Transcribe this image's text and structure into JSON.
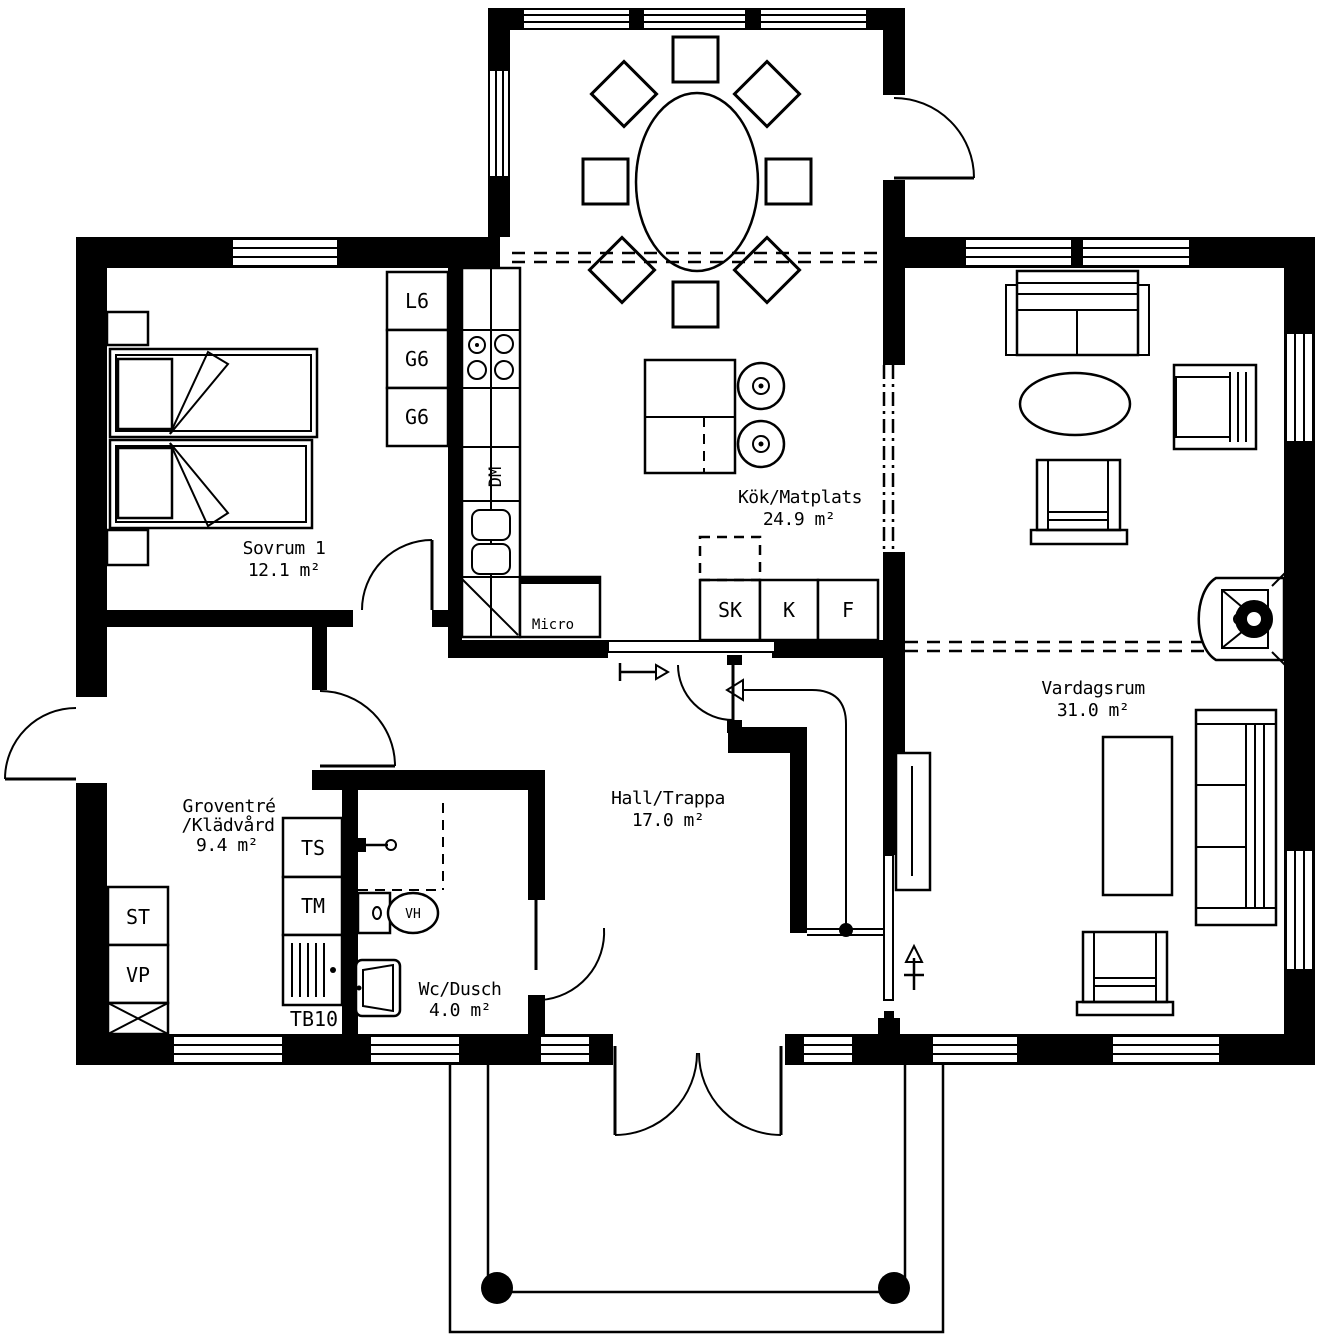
{
  "drawing": {
    "type": "floor-plan",
    "rooms": [
      {
        "name": "Sovrum 1",
        "area": "12.1 m²"
      },
      {
        "name": "Kök/Matplats",
        "area": "24.9 m²"
      },
      {
        "name": "Vardagsrum",
        "area": "31.0 m²"
      },
      {
        "name": "Hall/Trappa",
        "area": "17.0 m²"
      },
      {
        "name_line1": "Groventré",
        "name_line2": "/Klädvård",
        "area": "9.4 m²"
      },
      {
        "name": "Wc/Dusch",
        "area": "4.0 m²"
      }
    ],
    "kitchen": {
      "linen_cabinet": "L6",
      "wardrobe_1": "G6",
      "wardrobe_2": "G6",
      "dishwasher": "DM",
      "microwave": "Micro",
      "cleaning_cabinet": "SK",
      "fridge": "K",
      "freezer": "F"
    },
    "laundry": {
      "drying_cabinet": "TS",
      "washing_machine": "TM",
      "laundry_bench": "TB10",
      "storage": "ST",
      "heat_pump": "VP"
    },
    "bathroom": {
      "toilet": "VH"
    },
    "colors": {
      "walls": "#000000",
      "background": "#ffffff",
      "lines": "#000000"
    }
  }
}
